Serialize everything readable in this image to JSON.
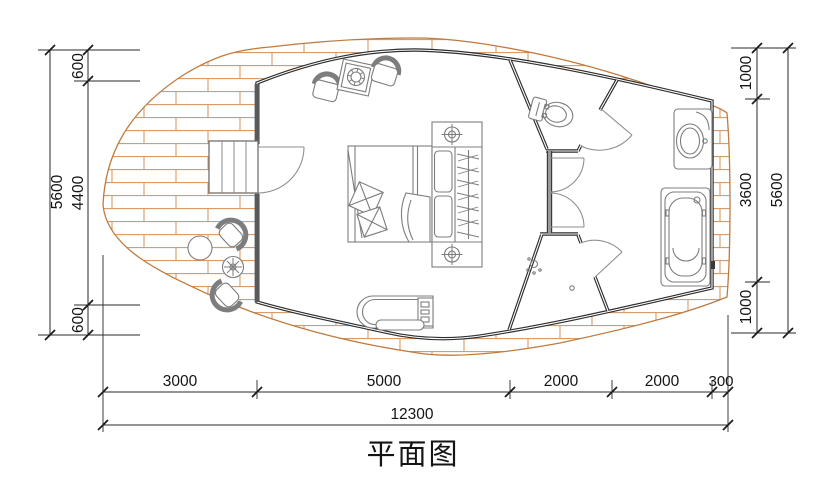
{
  "title": "平面图",
  "dimensions": {
    "left_outer_total": "5600",
    "left_segments": [
      "600",
      "4400",
      "600"
    ],
    "right_segments": [
      "1000",
      "3600",
      "1000"
    ],
    "right_outer_total": "5600",
    "bottom_segments": [
      "3000",
      "5000",
      "2000",
      "2000",
      "300"
    ],
    "bottom_total": "12300"
  },
  "colors": {
    "deck_hatch": "#d89a66",
    "deck_edge": "#c07a3e",
    "wall": "#2d2d2d",
    "furniture": "#7d7d7d",
    "dimension_text": "#141414"
  }
}
